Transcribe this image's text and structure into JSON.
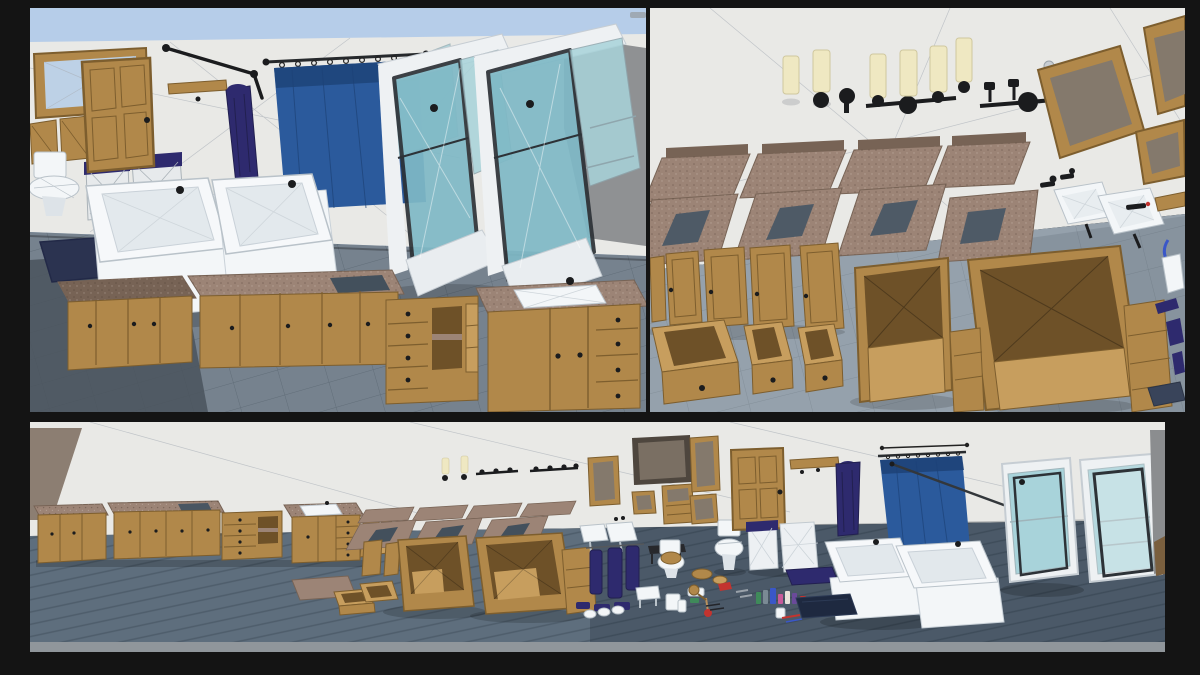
{
  "scene": {
    "description": "3D bathroom furniture asset pack shown in three engine viewport renders",
    "panels": {
      "top_left": {
        "name": "assembled bathroom wall scene",
        "objects": [
          "wood-framed mirror",
          "shuttered medicine cabinet",
          "toilet",
          "woven laundry baskets with navy lids",
          "wood panel door",
          "wall shelf",
          "black towel arm",
          "hanging navy bathrobe",
          "blue shower curtain on rod",
          "white bathtub",
          "white bathtub",
          "glass shower stall",
          "glass shower stall",
          "granite-top vanity cabinets",
          "open-shelf vanity unit",
          "vanity with inset sink",
          "navy bath rug"
        ]
      },
      "top_right": {
        "name": "vanity parts breakdown scene",
        "objects": [
          "candle wall sconces",
          "three-light vanity fixture",
          "bare fixture bar",
          "light bulb",
          "tilted wood-framed mirrors",
          "granite backsplash slabs",
          "granite counters with sink cutouts",
          "white drop-in sinks",
          "black faucets",
          "cabinet doors laid out",
          "drawer boxes",
          "open cabinet carcasses",
          "shelf towers",
          "navy accessories",
          "floor mat",
          "towel bar"
        ]
      },
      "bottom": {
        "name": "full asset lineup scene",
        "objects": [
          "vanity cabinet row with granite tops",
          "granite slab and drawer on floor",
          "floating countertop slabs",
          "small wall sconces and fixture bars",
          "framed mirrors",
          "medicine cabinet",
          "cabinet carcasses and drawer boxes",
          "drop-in sinks",
          "toilet with wood seat",
          "toilet",
          "black bench",
          "white side table",
          "bucket",
          "scale",
          "plunger",
          "toilet paper rolls",
          "hanging navy towels",
          "folded towels",
          "wood panel door",
          "hanging navy bathrobe",
          "wall shelf with hooks",
          "laundry baskets",
          "navy bath mat",
          "dimension guide line",
          "blue shower curtain with rod",
          "white bathtub",
          "white bathtub",
          "toiletry props cluster",
          "dark bath rugs",
          "glass shower stall",
          "glass shower stall"
        ]
      }
    }
  },
  "palette": {
    "backdrop": "#141414",
    "sky": "#b6cde9",
    "wall": "#e9e9e6",
    "wall_corner": "#8f9193",
    "taupe_wedge": "#8c7e72",
    "wire": "#aab0b8",
    "floor_a": "#76828e",
    "floor_a_dark": "#4a535d",
    "floor_b": "#95a1ac",
    "floor_c": "#5e6e7d",
    "floor_edge": "#90969b",
    "wood": "#b1884a",
    "wood_dark": "#7d5e2e",
    "wood_light": "#c79e5e",
    "wood_interior": "#6e5128",
    "granite": "#9c8476",
    "granite_dark": "#776355",
    "curtain": "#2b5a9c",
    "curtain_dark": "#1d4277",
    "glass": "#a8d3da",
    "glass_deep": "#7fb9c6",
    "frame_dark": "#2d3237",
    "fixture_white": "#f3f6f8",
    "fixture_shade": "#dde3e8",
    "fixture_line": "#b9c2c9",
    "navy": "#2e2a6e",
    "navy_dark": "#222050",
    "black": "#1b1c1e",
    "cream": "#efe8c2",
    "mirror_glass": "#84796c",
    "mirror_frame_dark": "#4e463e",
    "accent_red": "#c3342f",
    "accent_blue": "#3a57c8",
    "accent_green": "#3f8a5a",
    "accent_pink": "#c85a9a"
  }
}
